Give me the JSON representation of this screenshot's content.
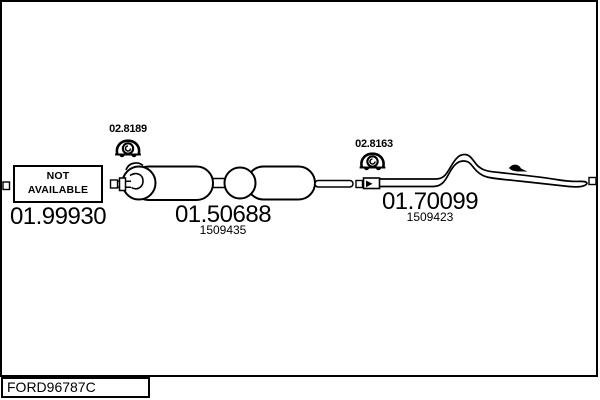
{
  "colors": {
    "line": "#000000",
    "background": "#ffffff"
  },
  "icons": {
    "mount_front": "rubber-mount-icon",
    "mount_rear": "rubber-mount-icon"
  },
  "parts": {
    "front": {
      "status_line1": "NOT",
      "status_line2": "AVAILABLE",
      "number": "01.99930"
    },
    "mount_front": {
      "number": "02.8189"
    },
    "silencer": {
      "number": "01.50688",
      "ref": "1509435"
    },
    "mount_rear": {
      "number": "02.8163"
    },
    "tailpipe": {
      "number": "01.70099",
      "ref": "1509423"
    }
  },
  "footer": {
    "code": "FORD96787C"
  }
}
